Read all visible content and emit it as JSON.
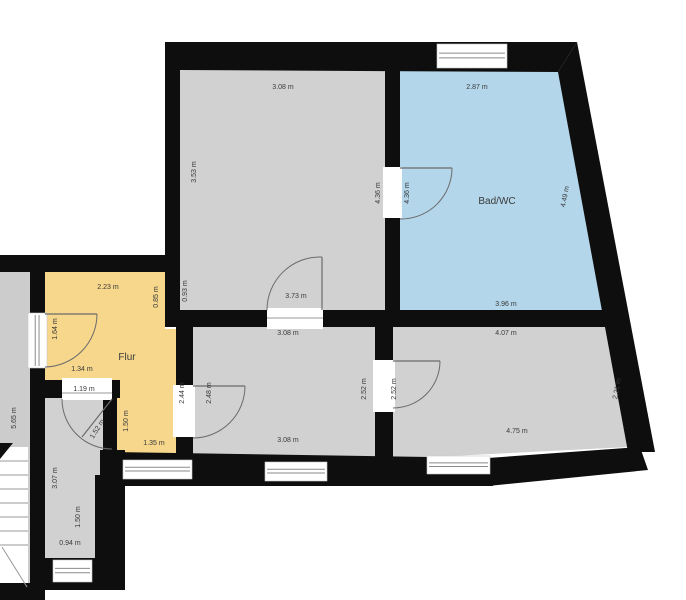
{
  "scene": {
    "width": 686,
    "height": 600,
    "background": "#ffffff"
  },
  "colors": {
    "wall": "#0e0e0e",
    "room_gray": "#d1d1d1",
    "bath_blue": "#b3d6ea",
    "hall_yellow": "#f6d78c",
    "landing_gray": "#cccccc",
    "opening_white": "#ffffff",
    "window_line": "#8a8a8a",
    "door_line": "#6b6b6b",
    "label_text": "#3a3a3a",
    "stair_line": "#9a9a9a"
  },
  "rooms": [
    {
      "name": "room-top-left",
      "fill": "room_gray",
      "points": "180,68 385,69 385,310 180,310"
    },
    {
      "name": "room-bad-wc",
      "fill": "bath_blue",
      "points": "400,69 558,71 604,310 400,310"
    },
    {
      "name": "room-flur",
      "fill": "hall_yellow",
      "points": "45,272 165,272 165,329 176,329 176,458 117,458 117,380 45,380"
    },
    {
      "name": "room-middle",
      "fill": "room_gray",
      "points": "193,327 375,327 375,460 193,460"
    },
    {
      "name": "room-bottom-right",
      "fill": "room_gray",
      "points": "393,327 606,327 629,447 393,459"
    },
    {
      "name": "room-small-bottom-left",
      "fill": "room_gray",
      "points": "45,398 105,398 105,476 96,476 96,562 45,562"
    },
    {
      "name": "staircase-landing-strip",
      "fill": "landing_gray",
      "points": "0,272 30,272 30,600 0,600"
    },
    {
      "name": "stair-flight-area",
      "fill": "opening_white",
      "points": "0,447 28,447 28,585 0,585"
    }
  ],
  "walls": [
    {
      "name": "wall-top",
      "points": "165,42 577,42 558,72 180,70"
    },
    {
      "name": "wall-left-top-room",
      "points": "165,42 180,42 180,327 165,327"
    },
    {
      "name": "wall-divider-top-rooms",
      "points": "385,46 400,46 400,310 385,310"
    },
    {
      "name": "wall-right-slanted",
      "points": "577,42 655,452 628,452 558,72"
    },
    {
      "name": "wall-horizontal-mid",
      "points": "165,310 620,310 624,327 165,327"
    },
    {
      "name": "wall-flur-top",
      "points": "0,255 180,255 180,272 0,272"
    },
    {
      "name": "wall-flur-left",
      "points": "30,255 45,255 45,600 30,600"
    },
    {
      "name": "wall-flur-middle",
      "points": "176,327 193,327 193,462 176,462"
    },
    {
      "name": "wall-middle-right",
      "points": "375,327 393,327 393,462 375,462"
    },
    {
      "name": "wall-bottom-band",
      "points": "108,452 493,458 493,486 108,486"
    },
    {
      "name": "wall-bottom-slanted",
      "points": "488,458 640,447 648,470 488,486"
    },
    {
      "name": "wall-small-room-top",
      "points": "30,380 120,380 120,398 30,398"
    },
    {
      "name": "wall-small-room-right-upper",
      "points": "103,380 117,380 117,452 103,452"
    },
    {
      "name": "wall-small-room-right-mid",
      "points": "100,450 125,450 125,480 100,480"
    },
    {
      "name": "wall-small-room-right-lower",
      "points": "95,475 125,475 125,583 95,583"
    },
    {
      "name": "wall-small-room-bottom",
      "points": "30,558 125,558 125,590 30,590"
    },
    {
      "name": "wall-bottom-left-corner",
      "points": "0,583 30,583 30,600 0,600"
    }
  ],
  "door_openings": [
    {
      "name": "door-opening-top-rooms",
      "x": 383,
      "y": 167,
      "w": 19,
      "h": 51
    },
    {
      "name": "door-opening-top-left-room",
      "x": 267,
      "y": 308,
      "w": 56,
      "h": 21
    },
    {
      "name": "door-opening-flur-entrance",
      "x": 28,
      "y": 313,
      "w": 19,
      "h": 55
    },
    {
      "name": "door-opening-small-room",
      "x": 62,
      "y": 378,
      "w": 50,
      "h": 22
    },
    {
      "name": "door-opening-middle-room",
      "x": 173,
      "y": 385,
      "w": 22,
      "h": 52
    },
    {
      "name": "door-opening-middle-right",
      "x": 373,
      "y": 360,
      "w": 22,
      "h": 52
    }
  ],
  "windows": [
    {
      "name": "window-top-bath",
      "x": 437,
      "y": 44,
      "w": 70,
      "h": 24,
      "dir": "h"
    },
    {
      "name": "window-flur-left",
      "x": 28,
      "y": 313,
      "w": 19,
      "h": 55,
      "dir": "v"
    },
    {
      "name": "window-bottom-flur",
      "x": 123,
      "y": 460,
      "w": 69,
      "h": 19,
      "dir": "h"
    },
    {
      "name": "window-bottom-middle",
      "x": 265,
      "y": 462,
      "w": 62,
      "h": 19,
      "dir": "h"
    },
    {
      "name": "window-bottom-right",
      "x": 427,
      "y": 456,
      "w": 63,
      "h": 18,
      "dir": "h"
    },
    {
      "name": "window-small-room-bottom",
      "x": 53,
      "y": 560,
      "w": 39,
      "h": 22,
      "dir": "h"
    }
  ],
  "doors": [
    {
      "name": "door-arc-top-rooms",
      "arc": "M400,219 A51,51 0 0 0 452,168",
      "leaf": "M400,168 L452,168"
    },
    {
      "name": "door-arc-top-left-room",
      "arc": "M267,310 A53,53 0 0 1 322,257",
      "leaf": "M322,310 L322,257"
    },
    {
      "name": "door-arc-flur-entrance",
      "arc": "M45,367 A53,53 0 0 0 97,314",
      "leaf": "M45,314 L97,314"
    },
    {
      "name": "door-arc-small-room",
      "arc": "M62,399 A50,50 0 0 0 112,449",
      "leaf": "M112,399 L82,437"
    },
    {
      "name": "door-arc-middle-room",
      "arc": "M193,438 A52,52 0 0 0 245,386",
      "leaf": "M193,386 L245,386"
    },
    {
      "name": "door-arc-middle-right",
      "arc": "M393,408 A47,47 0 0 0 440,361",
      "leaf": "M393,361 L440,361"
    }
  ],
  "thin_lines": [
    {
      "name": "dim-line-door-top-left",
      "x1": 267,
      "y1": 318,
      "x2": 323,
      "y2": 318
    },
    {
      "name": "dim-line-small-room-door",
      "x1": 62,
      "y1": 393,
      "x2": 112,
      "y2": 393
    },
    {
      "name": "stair-tread",
      "x1": 0,
      "y1": 461,
      "x2": 28,
      "y2": 461
    },
    {
      "name": "stair-tread",
      "x1": 0,
      "y1": 475,
      "x2": 28,
      "y2": 475
    },
    {
      "name": "stair-tread",
      "x1": 0,
      "y1": 489,
      "x2": 28,
      "y2": 489
    },
    {
      "name": "stair-tread",
      "x1": 0,
      "y1": 503,
      "x2": 28,
      "y2": 503
    },
    {
      "name": "stair-tread",
      "x1": 0,
      "y1": 517,
      "x2": 28,
      "y2": 517
    },
    {
      "name": "stair-tread",
      "x1": 0,
      "y1": 531,
      "x2": 28,
      "y2": 531
    },
    {
      "name": "stair-tread",
      "x1": 0,
      "y1": 545,
      "x2": 28,
      "y2": 545
    },
    {
      "name": "stair-cut-line",
      "x1": 2,
      "y1": 547,
      "x2": 27,
      "y2": 587
    }
  ],
  "stair_arrow": {
    "name": "stair-direction-arrow",
    "points": "0,443 13,443 0,459"
  },
  "room_labels": [
    {
      "name": "room-label-bad-wc",
      "text": "Bad/WC",
      "x": 497,
      "y": 204,
      "size": 10
    },
    {
      "name": "room-label-flur",
      "text": "Flur",
      "x": 127,
      "y": 360,
      "size": 10
    }
  ],
  "dimension_labels": [
    {
      "text": "3.08 m",
      "x": 283,
      "y": 89,
      "rot": 0
    },
    {
      "text": "3.53 m",
      "x": 196,
      "y": 172,
      "rot": -90
    },
    {
      "text": "0.93 m",
      "x": 187,
      "y": 291,
      "rot": -90
    },
    {
      "text": "2.87 m",
      "x": 477,
      "y": 89,
      "rot": 0
    },
    {
      "text": "4.36 m",
      "x": 380,
      "y": 193,
      "rot": -90
    },
    {
      "text": "4.36 m",
      "x": 409,
      "y": 193,
      "rot": -90
    },
    {
      "text": "4.49 m",
      "x": 567,
      "y": 197,
      "rot": -79
    },
    {
      "text": "3.96 m",
      "x": 506,
      "y": 306,
      "rot": 0
    },
    {
      "text": "3.73 m",
      "x": 296,
      "y": 298,
      "rot": 0
    },
    {
      "text": "2.23 m",
      "x": 108,
      "y": 289,
      "rot": 0
    },
    {
      "text": "0.85 m",
      "x": 158,
      "y": 297,
      "rot": -90
    },
    {
      "text": "1.64 m",
      "x": 57,
      "y": 329,
      "rot": -90
    },
    {
      "text": "1.34 m",
      "x": 82,
      "y": 371,
      "rot": 0
    },
    {
      "text": "2.44 m",
      "x": 184,
      "y": 393,
      "rot": -90
    },
    {
      "text": "2.48 m",
      "x": 211,
      "y": 393,
      "rot": -90
    },
    {
      "text": "3.08 m",
      "x": 288,
      "y": 335,
      "rot": 0
    },
    {
      "text": "3.08 m",
      "x": 288,
      "y": 442,
      "rot": 0
    },
    {
      "text": "2.52 m",
      "x": 366,
      "y": 389,
      "rot": -90
    },
    {
      "text": "2.52 m",
      "x": 396,
      "y": 389,
      "rot": -90
    },
    {
      "text": "4.07 m",
      "x": 506,
      "y": 335,
      "rot": 0
    },
    {
      "text": "2.21 m",
      "x": 619,
      "y": 389,
      "rot": -79
    },
    {
      "text": "4.75 m",
      "x": 517,
      "y": 433,
      "rot": 0
    },
    {
      "text": "1.19 m",
      "x": 84,
      "y": 391,
      "rot": 0
    },
    {
      "text": "1.52 m",
      "x": 99,
      "y": 430,
      "rot": -58
    },
    {
      "text": "1.50 m",
      "x": 128,
      "y": 421,
      "rot": -90
    },
    {
      "text": "1.35 m",
      "x": 154,
      "y": 445,
      "rot": 0
    },
    {
      "text": "3.07 m",
      "x": 57,
      "y": 478,
      "rot": -90
    },
    {
      "text": "1.50 m",
      "x": 80,
      "y": 517,
      "rot": -90
    },
    {
      "text": "0.94 m",
      "x": 70,
      "y": 545,
      "rot": 0
    },
    {
      "text": "5.65 m",
      "x": 16,
      "y": 418,
      "rot": -90
    }
  ]
}
